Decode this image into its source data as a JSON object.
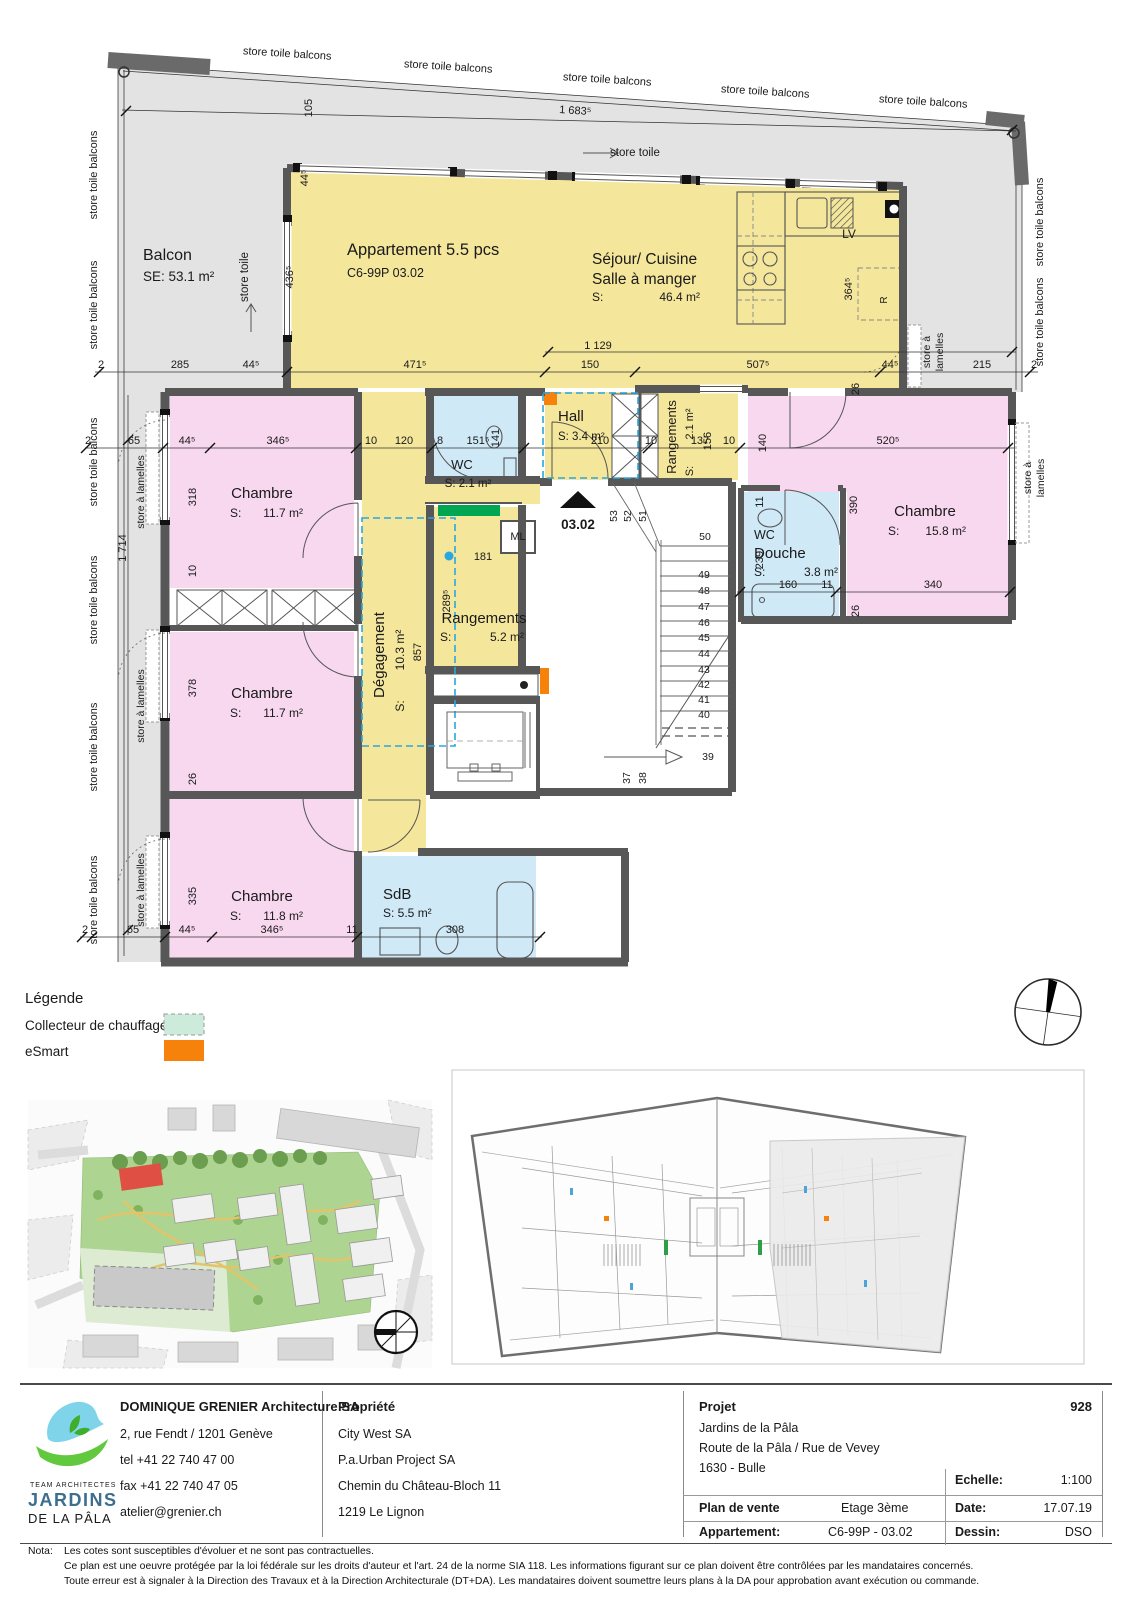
{
  "colors": {
    "wall": "#575757",
    "balc": "#e3e3e3",
    "yellow": "#f4e69b",
    "pink": "#f8d8ef",
    "blue": "#cfe9f6",
    "green": "#00a651",
    "mint": "#cdebda",
    "esmart": "#f6820c",
    "dash": "#2aa7df",
    "ink": "#1a1a1a"
  },
  "plan": {
    "texts": {
      "rooms": [
        {
          "t": "Balcon",
          "x": 143,
          "y": 260,
          "s": 16,
          "a": "start"
        },
        {
          "t": "SE: 53.1 m²",
          "x": 143,
          "y": 281,
          "s": 13.5,
          "a": "start"
        },
        {
          "t": "Appartement 5.5 pcs",
          "x": 347,
          "y": 255,
          "s": 16.5,
          "a": "start"
        },
        {
          "t": "C6-99P 03.02",
          "x": 347,
          "y": 277,
          "s": 12.5,
          "a": "start"
        },
        {
          "t": "Séjour/ Cuisine",
          "x": 592,
          "y": 264,
          "s": 15.5,
          "a": "start"
        },
        {
          "t": "Salle à manger",
          "x": 592,
          "y": 284,
          "s": 15.5,
          "a": "start"
        },
        {
          "t": "S:",
          "x": 592,
          "y": 301,
          "s": 12,
          "a": "start"
        },
        {
          "t": "46.4 m²",
          "x": 700,
          "y": 301,
          "s": 12,
          "a": "end"
        },
        {
          "t": "Chambre",
          "x": 262,
          "y": 498,
          "s": 15
        },
        {
          "t": "S:",
          "x": 230,
          "y": 517,
          "s": 12,
          "a": "start"
        },
        {
          "t": "11.7 m²",
          "x": 303,
          "y": 517,
          "s": 12,
          "a": "end"
        },
        {
          "t": "Chambre",
          "x": 262,
          "y": 698,
          "s": 15
        },
        {
          "t": "S:",
          "x": 230,
          "y": 717,
          "s": 12,
          "a": "start"
        },
        {
          "t": "11.7 m²",
          "x": 303,
          "y": 717,
          "s": 12,
          "a": "end"
        },
        {
          "t": "Chambre",
          "x": 262,
          "y": 901,
          "s": 15
        },
        {
          "t": "S:",
          "x": 230,
          "y": 920,
          "s": 12,
          "a": "start"
        },
        {
          "t": "11.8 m²",
          "x": 303,
          "y": 920,
          "s": 12,
          "a": "end"
        },
        {
          "t": "Chambre",
          "x": 925,
          "y": 516,
          "s": 15
        },
        {
          "t": "S:",
          "x": 888,
          "y": 535,
          "s": 12,
          "a": "start"
        },
        {
          "t": "15.8 m²",
          "x": 966,
          "y": 535,
          "s": 12,
          "a": "end"
        },
        {
          "t": "WC",
          "x": 462,
          "y": 469,
          "s": 13
        },
        {
          "t": "S: 2.1 m²",
          "x": 468,
          "y": 487,
          "s": 11.5
        },
        {
          "t": "Hall",
          "x": 558,
          "y": 421,
          "s": 15,
          "a": "start"
        },
        {
          "t": "S: 3.4 m²",
          "x": 558,
          "y": 440,
          "s": 11.5,
          "a": "start"
        },
        {
          "t": "WC",
          "x": 754,
          "y": 539,
          "s": 12.5,
          "a": "start"
        },
        {
          "t": "Douche",
          "x": 754,
          "y": 558,
          "s": 15,
          "a": "start"
        },
        {
          "t": "S:",
          "x": 754,
          "y": 576,
          "s": 12,
          "a": "start"
        },
        {
          "t": "3.8 m²",
          "x": 838,
          "y": 576,
          "s": 12,
          "a": "end"
        },
        {
          "t": "SdB",
          "x": 383,
          "y": 899,
          "s": 15,
          "a": "start"
        },
        {
          "t": "S: 5.5 m²",
          "x": 383,
          "y": 917,
          "s": 12,
          "a": "start"
        },
        {
          "t": "Rangements",
          "x": 484,
          "y": 623,
          "s": 15
        },
        {
          "t": "S:",
          "x": 440,
          "y": 641,
          "s": 12,
          "a": "start"
        },
        {
          "t": "5.2 m²",
          "x": 524,
          "y": 641,
          "s": 12,
          "a": "end"
        },
        {
          "t": "ML",
          "x": 518,
          "y": 540,
          "s": 11
        },
        {
          "t": "Rangements",
          "x": 676,
          "y": 437,
          "s": 13,
          "r": -90
        },
        {
          "t": "S:",
          "x": 693,
          "y": 471,
          "s": 11,
          "r": -90
        },
        {
          "t": "2.1 m²",
          "x": 693,
          "y": 424,
          "s": 11,
          "r": -90
        },
        {
          "t": "Dégagement",
          "x": 384,
          "y": 655,
          "s": 15,
          "r": -90
        },
        {
          "t": "S:",
          "x": 404,
          "y": 706,
          "s": 12,
          "r": -90
        },
        {
          "t": "10.3 m²",
          "x": 404,
          "y": 650,
          "s": 12,
          "r": -90
        },
        {
          "t": "857",
          "x": 421,
          "y": 652,
          "s": 11,
          "r": -90
        },
        {
          "t": "03.02",
          "x": 578,
          "y": 529,
          "s": 13.5,
          "w": "bold"
        },
        {
          "t": "LV",
          "x": 849,
          "y": 238,
          "s": 12
        },
        {
          "t": "R",
          "x": 887,
          "y": 300,
          "s": 10,
          "r": -90,
          "c": "#888"
        }
      ],
      "stores": [
        {
          "t": "store toile balcons",
          "x": 287,
          "y": 57,
          "s": 11,
          "r": 3.6
        },
        {
          "t": "store toile balcons",
          "x": 448,
          "y": 70,
          "s": 11,
          "r": 3.6
        },
        {
          "t": "store toile balcons",
          "x": 607,
          "y": 83,
          "s": 11,
          "r": 3.6
        },
        {
          "t": "store toile balcons",
          "x": 765,
          "y": 95,
          "s": 11,
          "r": 3.6
        },
        {
          "t": "store toile balcons",
          "x": 923,
          "y": 105,
          "s": 11,
          "r": 3.6
        },
        {
          "t": "store toile balcons",
          "x": 97,
          "y": 175,
          "s": 11,
          "r": -90
        },
        {
          "t": "store toile balcons",
          "x": 97,
          "y": 305,
          "s": 11,
          "r": -90
        },
        {
          "t": "store toile balcons",
          "x": 97,
          "y": 462,
          "s": 11,
          "r": -90
        },
        {
          "t": "store toile balcons",
          "x": 97,
          "y": 600,
          "s": 11,
          "r": -90
        },
        {
          "t": "store toile balcons",
          "x": 97,
          "y": 747,
          "s": 11,
          "r": -90
        },
        {
          "t": "store toile balcons",
          "x": 97,
          "y": 900,
          "s": 11,
          "r": -90
        },
        {
          "t": "store toile balcons",
          "x": 1043,
          "y": 222,
          "s": 11,
          "r": -90
        },
        {
          "t": "store toile balcons",
          "x": 1043,
          "y": 322,
          "s": 11,
          "r": -90
        },
        {
          "t": "store à lamelles",
          "x": 144,
          "y": 492,
          "s": 10.5,
          "r": -90
        },
        {
          "t": "store à lamelles",
          "x": 144,
          "y": 706,
          "s": 10.5,
          "r": -90
        },
        {
          "t": "store à lamelles",
          "x": 144,
          "y": 890,
          "s": 10.5,
          "r": -90
        },
        {
          "t": "store à",
          "x": 930,
          "y": 352,
          "s": 10.5,
          "r": -90
        },
        {
          "t": "lamelles",
          "x": 943,
          "y": 352,
          "s": 10.5,
          "r": -90
        },
        {
          "t": "store à",
          "x": 1031,
          "y": 478,
          "s": 10.5,
          "r": -90
        },
        {
          "t": "lamelles",
          "x": 1044,
          "y": 478,
          "s": 10.5,
          "r": -90
        },
        {
          "t": "store toile",
          "x": 610,
          "y": 156,
          "s": 11.5,
          "a": "start"
        },
        {
          "t": "store toile",
          "x": 248,
          "y": 277,
          "s": 11.5,
          "r": -90
        }
      ],
      "dims": [
        {
          "t": "2",
          "x": 101,
          "y": 368
        },
        {
          "t": "285",
          "x": 180,
          "y": 368
        },
        {
          "t": "44⁵",
          "x": 251,
          "y": 368
        },
        {
          "t": "471⁵",
          "x": 415,
          "y": 368
        },
        {
          "t": "150",
          "x": 590,
          "y": 368
        },
        {
          "t": "507⁵",
          "x": 758,
          "y": 368
        },
        {
          "t": "44⁵",
          "x": 890,
          "y": 368
        },
        {
          "t": "215",
          "x": 982,
          "y": 368
        },
        {
          "t": "2",
          "x": 1034,
          "y": 368
        },
        {
          "t": "1 129",
          "x": 598,
          "y": 349
        },
        {
          "t": "1 683⁵",
          "x": 575,
          "y": 114,
          "r": 3.6
        },
        {
          "t": "105",
          "x": 312,
          "y": 108,
          "r": -90
        },
        {
          "t": "44⁵",
          "x": 308,
          "y": 178,
          "r": -90
        },
        {
          "t": "436⁵",
          "x": 293,
          "y": 277,
          "r": -90
        },
        {
          "t": "364⁵",
          "x": 852,
          "y": 289,
          "r": -90
        },
        {
          "t": "26",
          "x": 859,
          "y": 389,
          "r": -90
        },
        {
          "t": "2",
          "x": 88,
          "y": 444
        },
        {
          "t": "65",
          "x": 134,
          "y": 444
        },
        {
          "t": "44⁵",
          "x": 187,
          "y": 444
        },
        {
          "t": "346⁵",
          "x": 278,
          "y": 444
        },
        {
          "t": "10",
          "x": 371,
          "y": 444
        },
        {
          "t": "120",
          "x": 404,
          "y": 444
        },
        {
          "t": "8",
          "x": 440,
          "y": 444
        },
        {
          "t": "151⁵",
          "x": 478,
          "y": 444
        },
        {
          "t": "210",
          "x": 600,
          "y": 444
        },
        {
          "t": "10",
          "x": 651,
          "y": 444
        },
        {
          "t": "137",
          "x": 700,
          "y": 444
        },
        {
          "t": "10",
          "x": 729,
          "y": 444
        },
        {
          "t": "520⁵",
          "x": 888,
          "y": 444
        },
        {
          "t": "141",
          "x": 499,
          "y": 438,
          "r": -90
        },
        {
          "t": "156",
          "x": 711,
          "y": 441,
          "r": -90
        },
        {
          "t": "140",
          "x": 766,
          "y": 443,
          "r": -90
        },
        {
          "t": "1 714",
          "x": 126,
          "y": 548,
          "r": -90
        },
        {
          "t": "318",
          "x": 196,
          "y": 497,
          "r": -90
        },
        {
          "t": "10",
          "x": 196,
          "y": 571,
          "r": -90
        },
        {
          "t": "378",
          "x": 196,
          "y": 688,
          "r": -90
        },
        {
          "t": "26",
          "x": 196,
          "y": 779,
          "r": -90
        },
        {
          "t": "335",
          "x": 196,
          "y": 896,
          "r": -90
        },
        {
          "t": "181",
          "x": 483,
          "y": 560
        },
        {
          "t": "289⁵",
          "x": 450,
          "y": 601,
          "r": -90
        },
        {
          "t": "11",
          "x": 763,
          "y": 502,
          "r": -90
        },
        {
          "t": "239",
          "x": 763,
          "y": 560,
          "r": -90
        },
        {
          "t": "390",
          "x": 857,
          "y": 505,
          "r": -90
        },
        {
          "t": "26",
          "x": 859,
          "y": 611,
          "r": -90
        },
        {
          "t": "160",
          "x": 788,
          "y": 588
        },
        {
          "t": "11",
          "x": 827,
          "y": 588
        },
        {
          "t": "340",
          "x": 933,
          "y": 588
        },
        {
          "t": "2",
          "x": 85,
          "y": 933
        },
        {
          "t": "65",
          "x": 133,
          "y": 933
        },
        {
          "t": "44⁵",
          "x": 187,
          "y": 933
        },
        {
          "t": "346⁵",
          "x": 272,
          "y": 933
        },
        {
          "t": "11",
          "x": 352,
          "y": 933
        },
        {
          "t": "308",
          "x": 455,
          "y": 933
        }
      ],
      "stairs": [
        {
          "t": "53",
          "x": 617,
          "y": 516,
          "s": 10.5,
          "r": -90
        },
        {
          "t": "52",
          "x": 631,
          "y": 516,
          "s": 10.5,
          "r": -90
        },
        {
          "t": "51",
          "x": 646,
          "y": 516,
          "s": 10.5,
          "r": -90
        },
        {
          "t": "50",
          "x": 705,
          "y": 540,
          "s": 10.5
        },
        {
          "t": "49",
          "x": 704,
          "y": 578,
          "s": 10.5
        },
        {
          "t": "48",
          "x": 704,
          "y": 594,
          "s": 10.5
        },
        {
          "t": "47",
          "x": 704,
          "y": 610,
          "s": 10.5
        },
        {
          "t": "46",
          "x": 704,
          "y": 626,
          "s": 10.5
        },
        {
          "t": "45",
          "x": 704,
          "y": 641,
          "s": 10.5
        },
        {
          "t": "44",
          "x": 704,
          "y": 657,
          "s": 10.5
        },
        {
          "t": "43",
          "x": 704,
          "y": 673,
          "s": 10.5
        },
        {
          "t": "42",
          "x": 704,
          "y": 688,
          "s": 10.5
        },
        {
          "t": "41",
          "x": 704,
          "y": 703,
          "s": 10.5
        },
        {
          "t": "40",
          "x": 704,
          "y": 718,
          "s": 10.5
        },
        {
          "t": "39",
          "x": 708,
          "y": 760,
          "s": 10.5
        },
        {
          "t": "38",
          "x": 646,
          "y": 778,
          "s": 10.5,
          "r": -90
        },
        {
          "t": "37",
          "x": 630,
          "y": 778,
          "s": 10.5,
          "r": -90
        }
      ]
    },
    "ticks": [
      {
        "x": 99,
        "y": 372
      },
      {
        "x": 287,
        "y": 372
      },
      {
        "x": 545,
        "y": 372
      },
      {
        "x": 635,
        "y": 372
      },
      {
        "x": 880,
        "y": 372
      },
      {
        "x": 1030,
        "y": 372
      },
      {
        "x": 548,
        "y": 352
      },
      {
        "x": 1012,
        "y": 352
      },
      {
        "x": 126,
        "y": 111
      },
      {
        "x": 1012,
        "y": 130
      },
      {
        "x": 86,
        "y": 448
      },
      {
        "x": 163,
        "y": 448
      },
      {
        "x": 210,
        "y": 448
      },
      {
        "x": 356,
        "y": 448
      },
      {
        "x": 432,
        "y": 448
      },
      {
        "x": 524,
        "y": 448
      },
      {
        "x": 648,
        "y": 448
      },
      {
        "x": 740,
        "y": 448
      },
      {
        "x": 1008,
        "y": 448
      },
      {
        "x": 82,
        "y": 937
      },
      {
        "x": 92,
        "y": 937
      },
      {
        "x": 165,
        "y": 937
      },
      {
        "x": 212,
        "y": 937
      },
      {
        "x": 357,
        "y": 937
      },
      {
        "x": 540,
        "y": 937
      },
      {
        "x": 740,
        "y": 592
      },
      {
        "x": 836,
        "y": 592
      },
      {
        "x": 1010,
        "y": 592
      },
      {
        "x": 128,
        "y": 440
      },
      {
        "x": 128,
        "y": 930
      }
    ]
  },
  "legend": {
    "title": "Légende",
    "items": [
      {
        "label": "Collecteur de chauffage"
      },
      {
        "label": "eSmart"
      }
    ]
  },
  "titleblock": {
    "architect": {
      "name": "DOMINIQUE GRENIER Architecture SA",
      "address": "2, rue Fendt / 1201 Genève",
      "tel": "tel  +41 22 740 47 00",
      "fax": "fax +41 22 740 47 05",
      "email": "atelier@grenier.ch"
    },
    "logo": {
      "line1": "TEAM ARCHITECTES",
      "line2": "JARDINS",
      "line3": "DE LA PÂLA"
    },
    "propriete": {
      "title": "Propriété",
      "lines": [
        "City West SA",
        "P.a.Urban Project SA",
        "Chemin du Château-Bloch 11",
        "1219 Le Lignon"
      ]
    },
    "projet": {
      "title": "Projet",
      "number": "928",
      "lines": [
        "Jardins de la Pâla",
        "Route de la Pâla / Rue de Vevey",
        "1630 - Bulle"
      ],
      "echelle_label": "Echelle:",
      "echelle": "1:100",
      "plan_label": "Plan de vente",
      "etage": "Etage 3ème",
      "date_label": "Date:",
      "date": "17.07.19",
      "appartement_label": "Appartement:",
      "appartement": "C6-99P - 03.02",
      "dessin_label": "Dessin:",
      "dessin": "DSO"
    }
  },
  "nota": {
    "label": "Nota:",
    "lines": [
      "Les cotes sont susceptibles d'évoluer et ne sont pas contractuelles.",
      "Ce plan est une oeuvre protégée par la loi fédérale sur les droits d'auteur et l'art. 24 de la norme SIA 118. Les informations figurant sur ce plan doivent être contrôlées par les mandataires concernés.",
      "Toute erreur est à signaler à la Direction des Travaux et à la Direction Architecturale (DT+DA). Les mandataires doivent soumettre leurs plans à la DA pour approbation avant exécution ou commande."
    ]
  }
}
